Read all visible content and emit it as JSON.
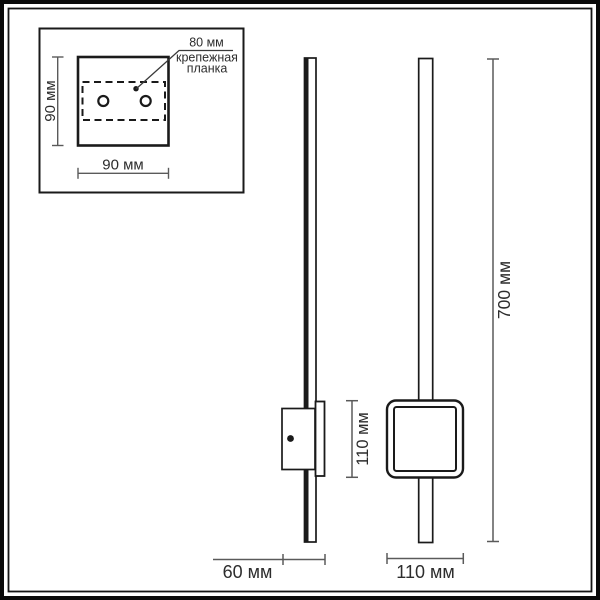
{
  "labels": {
    "bracket_width": "80 мм",
    "bracket_name_line1": "крепежная",
    "bracket_name_line2": "планка",
    "plate_height": "90 мм",
    "plate_width": "90 мм",
    "fixture_depth": "60 мм",
    "shade_height": "110 мм",
    "shade_width": "110 мм",
    "lamp_length": "700 мм"
  },
  "colors": {
    "object_line": "#1a1a1a",
    "dimension_line": "#5a5a5a",
    "text": "#2d2d2d",
    "background": "#ffffff"
  }
}
